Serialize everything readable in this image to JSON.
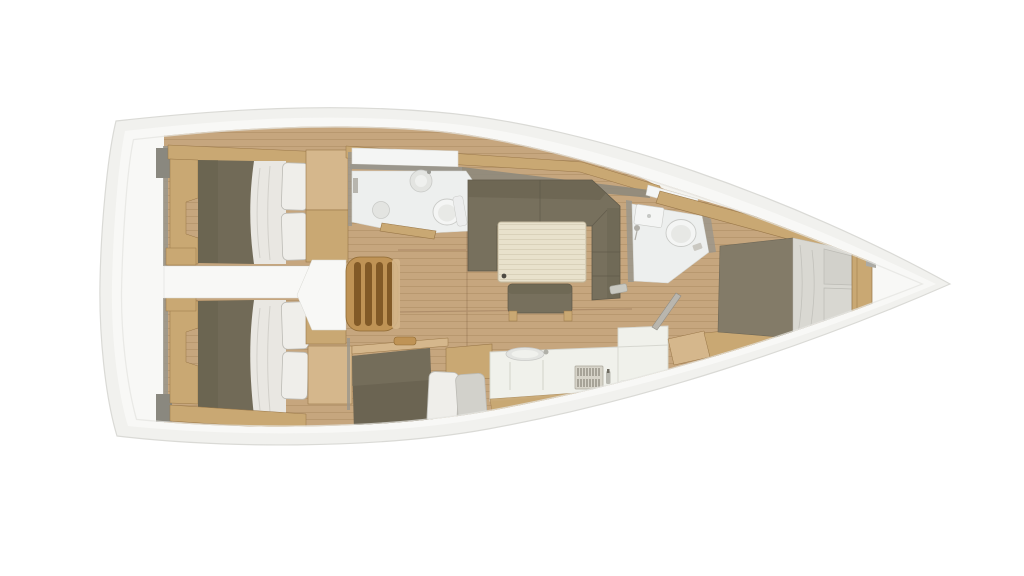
{
  "diagram": {
    "type": "floor-plan",
    "subject": "sailing-yacht-interior-top-view",
    "orientation": {
      "bow": "right",
      "stern": "left"
    },
    "areas": [
      "stern-platform",
      "aft-cabin-port",
      "aft-cabin-starboard",
      "companionway-steps",
      "aft-head",
      "saloon",
      "galley",
      "mid-cabin-berth",
      "forward-head",
      "forward-cabin"
    ],
    "furniture": [
      "double-berth-port",
      "double-berth-starboard",
      "single-berth-mid",
      "l-shaped-sofa",
      "saloon-table",
      "bench-seat",
      "galley-counter",
      "galley-sink",
      "vent-grille",
      "toilet-aft",
      "washbasin-aft",
      "toilet-forward",
      "shower-forward",
      "double-berth-forward",
      "wardrobes",
      "companionway-ladder"
    ]
  },
  "colors": {
    "background": "#ffffff",
    "hull_rim": "#f1f1ee",
    "hull_stroke": "#dadad6",
    "hull_white": "#f8f8f6",
    "deck_shadow": "#e4e4e0",
    "floor_wood": "#c6a67e",
    "plank_line": "#9c7a52",
    "cabinet_wood": "#c9a873",
    "cabinet_wood_light": "#d5b78c",
    "steps_wood": "#bf9355",
    "steps_slat": "#7c5423",
    "wood_edge": "#997748",
    "sofa_olive": "#77705d",
    "sofa_olive_dark": "#655e4c",
    "bed_olive": "#716a57",
    "bed_olive_dark": "#615b49",
    "fwd_bed_olive": "#837b68",
    "bedding_white": "#e9e7e2",
    "pillow_white": "#efeeea",
    "pillow_grey": "#d2d1cb",
    "pillow_stroke": "#bcbbb5",
    "bath_floor": "#edefee",
    "fixture_white": "#f4f5f4",
    "fixture_shadow": "#c9cac7",
    "basin_grey": "#e3e4e1",
    "table_cream": "#e8e1cc",
    "table_stripe": "#d9d1ba",
    "counter_white": "#f0f1eb",
    "counter_stroke": "#d6d7d0",
    "grille_base": "#d7d4c9",
    "grille_slat": "#6d685c",
    "wall_grey": "#9a968c",
    "shelf_grey": "#8e897c",
    "dark_block": "#8a887f",
    "door_grey": "#b9b6ae"
  }
}
